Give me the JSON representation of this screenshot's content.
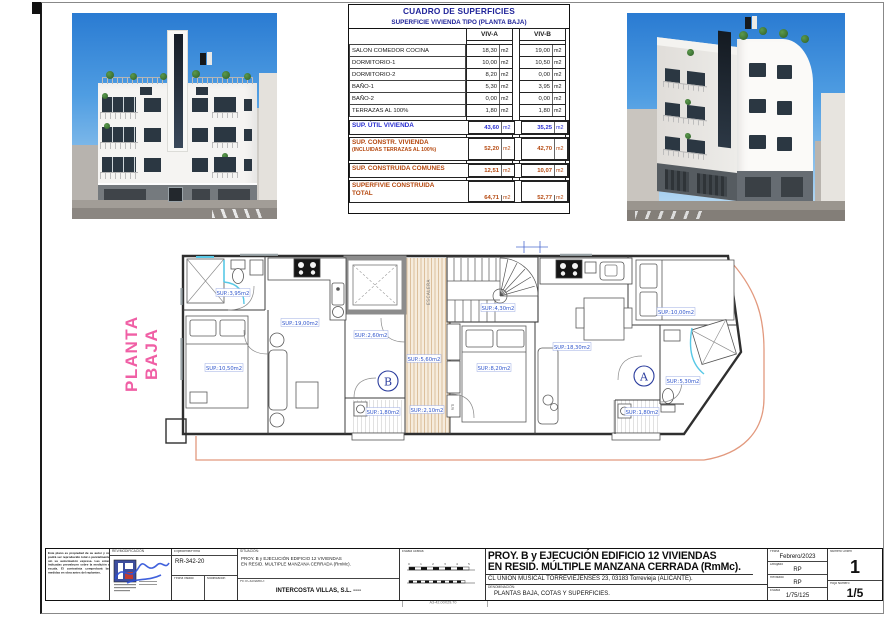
{
  "colors": {
    "pink_accent": "#f05fa5",
    "table_navy": "#20249a",
    "table_blue": "#2a2fd0",
    "table_red": "#b5480f",
    "plan_label_blue": "#2f55cc",
    "boundary_orange": "#e2997e",
    "hatch_tan": "#d9bb96",
    "shower_cyan": "#58c8e6",
    "sky_blue": "#2a7bd2"
  },
  "table": {
    "title": "CUADRO DE SUPERFICIES",
    "subtitle": "SUPERFICIE VIVIENDA TIPO  (PLANTA BAJA)",
    "col_a": "VIV-A",
    "col_b": "VIV-B",
    "unit": "m2",
    "rows": [
      {
        "label": "SALON COMEDOR COCINA",
        "a": "18,30",
        "b": "19,00"
      },
      {
        "label": "DORMITORIO-1",
        "a": "10,00",
        "b": "10,50"
      },
      {
        "label": "DORMITORIO-2",
        "a": "8,20",
        "b": "0,00"
      },
      {
        "label": "BAÑO-1",
        "a": "5,30",
        "b": "3,95"
      },
      {
        "label": "BAÑO-2",
        "a": "0,00",
        "b": "0,00"
      },
      {
        "label": "TERRAZAS AL 100%",
        "a": "1,80",
        "b": "1,80"
      }
    ],
    "util": {
      "label": "SUP. ÚTIL VIVIENDA",
      "a": "43,60",
      "b": "35,25"
    },
    "constr": {
      "label": "SUP. CONSTR. VIVIENDA",
      "sublabel": "(INCLUIDAS TERRAZAS AL 100%)",
      "a": "52,20",
      "b": "42,70"
    },
    "comunes": {
      "label": "SUP. CONSTRUIDA COMUNES",
      "a": "12,51",
      "b": "10,07"
    },
    "total": {
      "label": "SUPERFIVIE CONSTRUIDA",
      "label2": "TOTAL",
      "a": "64,71",
      "b": "52,77"
    }
  },
  "plan": {
    "side_label": "PLANTA BAJA",
    "stair_label": "ESCALERA",
    "riti_label": "RITI",
    "unit_a": "A",
    "unit_b": "B",
    "labels": [
      {
        "text": "SUP.:3,95m2"
      },
      {
        "text": "SUP.:19,00m2"
      },
      {
        "text": "SUP.:10,50m2"
      },
      {
        "text": "SUP.:2,60m2"
      },
      {
        "text": "SUP.:4,30m2"
      },
      {
        "text": "SUP.:5,60m2"
      },
      {
        "text": "SUP.:8,20m2"
      },
      {
        "text": "SUP.:18,30m2"
      },
      {
        "text": "SUP.:1,80m2"
      },
      {
        "text": "SUP.:2,10m2"
      },
      {
        "text": "SUP.:1,80m2"
      },
      {
        "text": "SUP.:10,00m2"
      },
      {
        "text": "SUP.:5,30m2"
      }
    ]
  },
  "titleblock": {
    "revision_header": "REV/MODIFICACIÓN",
    "expediente_header": "Expediente/Firma",
    "expediente": "RR-342-20",
    "fecha_visado_label": "Fecha visado",
    "modificacion_label": "Modificación",
    "situacion_label": "SITUACIÓN:",
    "situacion_line1": "PROY. B y EJECUCIÓN  EDIFICIO 12 VIVIENDAS",
    "situacion_line2": "EN RESID. MULTIPLE MANZANA CERRADA (RmMc).",
    "peticionario_label": "PETICIONARIO:",
    "peticionario": "INTERCOSTA VILLAS, S.L. ----",
    "escala_grafica_label": "Escala Gráfica",
    "title_line1": "PROY. B y EJECUCIÓN  EDIFICIO 12 VIVIENDAS",
    "title_line2": "EN RESID. MÚLTIPLE MANZANA CERRADA (RmMc).",
    "address": "CL UNION MUSICAL TORREVIEJENSES 23, 03183  Torrevieja (ALICANTE).",
    "denominacion_label": "DENOMINACIÓN:",
    "denominacion": "PLANTAS BAJA, COTAS Y SUPERFICIES.",
    "fecha_label": "Fecha",
    "fecha_value": "Febrero/2023",
    "dibujado_label": "Dibujado",
    "dibujado_value": "RP",
    "revisado_label": "Revisado",
    "revisado_value": "RP",
    "escala_label": "Escala",
    "escala_value": "1/75/125",
    "numero_orden_label": "Numero Orden",
    "numero_orden_value": "1",
    "hoja_label": "Hoja Numero",
    "hoja_value": "1/5",
    "disclaimer": "Este plano es propiedad de su autor y no podrá ser reproducido total o parcialmente sin su autorización expresa. Las cotas indicadas prevalecen sobre la medición a escala. El contratista comprobará las medidas en obra antes del replanteo."
  },
  "sheet": {
    "format_label": "A3-42.00X29.70"
  }
}
